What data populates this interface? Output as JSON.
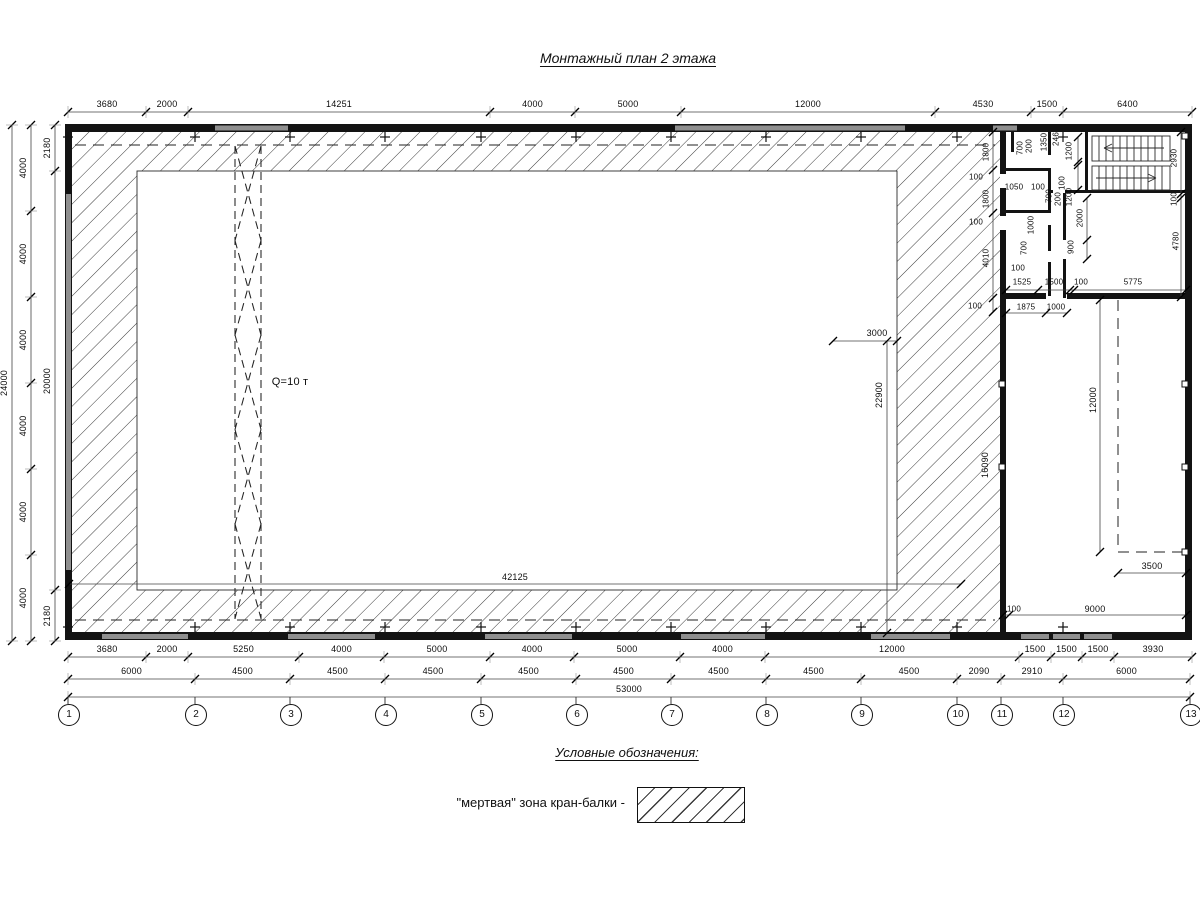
{
  "title": "Монтажный план 2 этажа",
  "crane": {
    "label": "Q=10 т"
  },
  "legend": {
    "heading": "Условные обозначения:",
    "item_label": "\"мертвая\" зона кран-балки -",
    "symbol": "hatch-swatch"
  },
  "colors": {
    "wall": "#131313",
    "window": "#8f8f8f",
    "hatch_line": "#3a3a3a"
  },
  "axis_bubbles": {
    "labels": [
      "1",
      "2",
      "3",
      "4",
      "5",
      "6",
      "7",
      "8",
      "9",
      "10",
      "11",
      "12",
      "13"
    ],
    "x": [
      68,
      195,
      290,
      385,
      481,
      576,
      671,
      766,
      861,
      957,
      1001,
      1063,
      1190
    ],
    "y": 714
  },
  "dim_chains": [
    {
      "name": "top-row",
      "orient": "h",
      "line": 112,
      "ticks": [
        68,
        146,
        188,
        490,
        575,
        681,
        935,
        1031,
        1063,
        1192
      ],
      "labels": [
        "3680",
        "2000",
        "14251",
        "4000",
        "5000",
        "12000",
        "4530",
        "1500",
        "6400"
      ]
    },
    {
      "name": "bottom-row-1",
      "orient": "h",
      "line": 657,
      "ticks": [
        68,
        146,
        188,
        299,
        384,
        490,
        574,
        680,
        765,
        1019,
        1051,
        1082,
        1114,
        1192
      ],
      "labels": [
        "3680",
        "2000",
        "5250",
        "4000",
        "5000",
        "4000",
        "5000",
        "4000",
        "12000",
        "1500",
        "1500",
        "1500",
        "3930"
      ]
    },
    {
      "name": "bottom-row-2",
      "orient": "h",
      "line": 679,
      "ticks": [
        68,
        195,
        290,
        385,
        481,
        576,
        671,
        766,
        861,
        957,
        1001,
        1063,
        1190
      ],
      "labels": [
        "6000",
        "4500",
        "4500",
        "4500",
        "4500",
        "4500",
        "4500",
        "4500",
        "4500",
        "2090",
        "2910",
        "6000"
      ]
    },
    {
      "name": "bottom-row-3",
      "orient": "h",
      "line": 697,
      "ticks": [
        68,
        1190
      ],
      "labels": [
        "53000"
      ]
    },
    {
      "name": "left-inner",
      "orient": "v",
      "line": 55,
      "ticks": [
        125,
        171,
        590,
        641
      ],
      "labels": [
        "2180",
        "20000",
        "2180"
      ]
    },
    {
      "name": "left-middle",
      "orient": "v",
      "line": 31,
      "ticks": [
        125,
        211,
        297,
        383,
        469,
        555,
        641
      ],
      "labels": [
        "4000",
        "4000",
        "4000",
        "4000",
        "4000",
        "4000"
      ]
    },
    {
      "name": "left-outer",
      "orient": "v",
      "line": 12,
      "ticks": [
        125,
        641
      ],
      "labels": [
        "24000"
      ]
    }
  ],
  "free_labels": [
    {
      "t": "Q=10 т",
      "x": 290,
      "y": 382,
      "r": 0,
      "s": 11
    },
    {
      "t": "42125",
      "x": 515,
      "y": 577,
      "r": 0
    },
    {
      "t": "3000",
      "x": 877,
      "y": 333,
      "r": 0
    },
    {
      "t": "22900",
      "x": 879,
      "y": 395,
      "r": -90
    },
    {
      "t": "1800",
      "x": 986,
      "y": 152,
      "r": -90,
      "s": 8
    },
    {
      "t": "100",
      "x": 976,
      "y": 177,
      "r": 0,
      "s": 8
    },
    {
      "t": "1800",
      "x": 986,
      "y": 199,
      "r": -90,
      "s": 8
    },
    {
      "t": "100",
      "x": 976,
      "y": 222,
      "r": 0,
      "s": 8
    },
    {
      "t": "4010",
      "x": 986,
      "y": 258,
      "r": -90,
      "s": 8
    },
    {
      "t": "100",
      "x": 975,
      "y": 306,
      "r": 0,
      "s": 8
    },
    {
      "t": "1050",
      "x": 1014,
      "y": 187,
      "r": 0,
      "s": 8
    },
    {
      "t": "100",
      "x": 1038,
      "y": 187,
      "r": 0,
      "s": 8
    },
    {
      "t": "700",
      "x": 1020,
      "y": 148,
      "r": -90,
      "s": 8
    },
    {
      "t": "200",
      "x": 1029,
      "y": 146,
      "r": -90,
      "s": 8
    },
    {
      "t": "1350",
      "x": 1044,
      "y": 142,
      "r": -90,
      "s": 8
    },
    {
      "t": "246",
      "x": 1056,
      "y": 139,
      "r": -90,
      "s": 8
    },
    {
      "t": "1200",
      "x": 1069,
      "y": 151,
      "r": -90,
      "s": 8
    },
    {
      "t": "100",
      "x": 1062,
      "y": 183,
      "r": -90,
      "s": 8
    },
    {
      "t": "1200",
      "x": 1069,
      "y": 197,
      "r": -90,
      "s": 8
    },
    {
      "t": "2930",
      "x": 1174,
      "y": 158,
      "r": -90,
      "s": 8
    },
    {
      "t": "100",
      "x": 1174,
      "y": 199,
      "r": -90,
      "s": 8
    },
    {
      "t": "4780",
      "x": 1176,
      "y": 241,
      "r": -90,
      "s": 8
    },
    {
      "t": "700",
      "x": 1049,
      "y": 196,
      "r": -90,
      "s": 8
    },
    {
      "t": "200",
      "x": 1058,
      "y": 199,
      "r": -90,
      "s": 8
    },
    {
      "t": "1000",
      "x": 1031,
      "y": 225,
      "r": -90,
      "s": 8
    },
    {
      "t": "700",
      "x": 1024,
      "y": 248,
      "r": -90,
      "s": 8
    },
    {
      "t": "2000",
      "x": 1080,
      "y": 218,
      "r": -90,
      "s": 8
    },
    {
      "t": "900",
      "x": 1071,
      "y": 247,
      "r": -90,
      "s": 8
    },
    {
      "t": "100",
      "x": 1018,
      "y": 268,
      "r": 0,
      "s": 8
    },
    {
      "t": "1525",
      "x": 1022,
      "y": 282,
      "r": 0,
      "s": 8
    },
    {
      "t": "1500",
      "x": 1054,
      "y": 282,
      "r": 0,
      "s": 8
    },
    {
      "t": "100",
      "x": 1081,
      "y": 282,
      "r": 0,
      "s": 8
    },
    {
      "t": "5775",
      "x": 1133,
      "y": 282,
      "r": 0,
      "s": 8
    },
    {
      "t": "1875",
      "x": 1026,
      "y": 307,
      "r": 0,
      "s": 8
    },
    {
      "t": "1000",
      "x": 1056,
      "y": 307,
      "r": 0,
      "s": 8
    },
    {
      "t": "16090",
      "x": 985,
      "y": 465,
      "r": -90
    },
    {
      "t": "12000",
      "x": 1093,
      "y": 400,
      "r": -90
    },
    {
      "t": "3500",
      "x": 1152,
      "y": 566,
      "r": 0
    },
    {
      "t": "100",
      "x": 1014,
      "y": 609,
      "r": 0,
      "s": 8
    },
    {
      "t": "9000",
      "x": 1095,
      "y": 609,
      "r": 0
    }
  ]
}
